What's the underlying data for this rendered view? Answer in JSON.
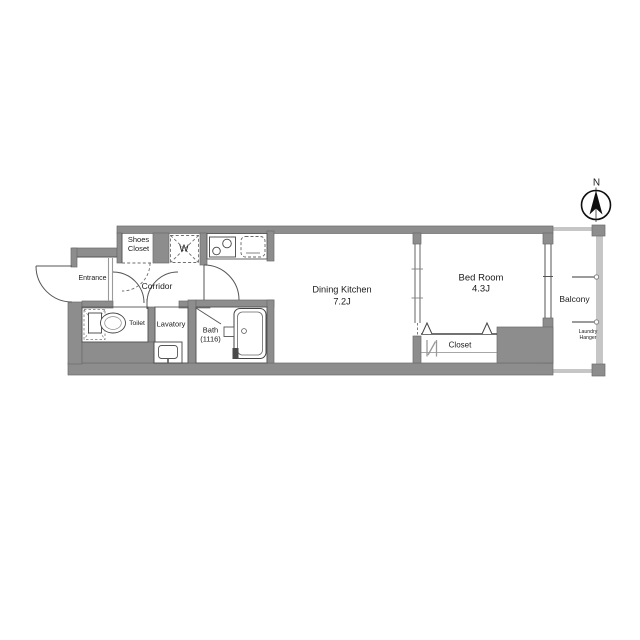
{
  "floor_plan": {
    "compass_north_label": "N",
    "labels": {
      "entrance": "Entrance",
      "shoes_closet_line1": "Shoes",
      "shoes_closet_line2": "Closet",
      "corridor": "Corridor",
      "washing_machine": "W",
      "toilet": "Toilet",
      "lavatory": "Lavatory",
      "bath_name": "Bath",
      "bath_size": "(1116)",
      "dining_kitchen_name": "Dining Kitchen",
      "dining_kitchen_area": "7.2J",
      "bedroom_name": "Bed Room",
      "bedroom_area": "4.3J",
      "closet": "Closet",
      "balcony": "Balcony",
      "laundry_hanger_line1": "Laundry",
      "laundry_hanger_line2": "Hanger"
    },
    "colors": {
      "wall": "#8d8d8d",
      "line": "#555555",
      "railing": "#c6c6c6",
      "text": "#1b1b1b",
      "background": "#ffffff"
    }
  }
}
